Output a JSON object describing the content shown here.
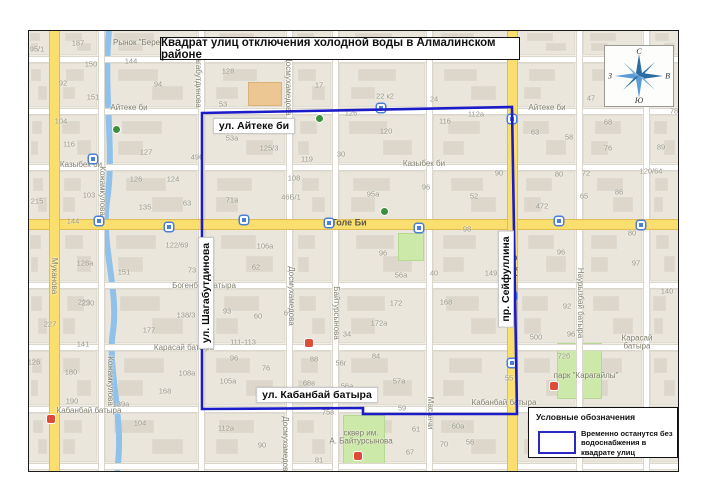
{
  "title": {
    "text": "Квадрат улиц  отключения холодной воды в Алмалинском районе"
  },
  "compass": {
    "north": "С",
    "east": "В",
    "south": "Ю",
    "west": "З"
  },
  "legend": {
    "heading": "Условные обозначения",
    "item": "Временно останутся без водоснабжения в квадрате улиц"
  },
  "colors": {
    "outline": "#1b1bc8",
    "swatch_border": "#2a2ac0",
    "major_road": "#fbdf6e",
    "major_road_edge": "#e0bc55",
    "road": "#ffffff",
    "road_edge": "#dbd7cd",
    "water": "#8fc1ea",
    "park": "#cde9a9",
    "park_edge": "#b7d893",
    "map_bg": "#f1eee6",
    "block": "#eae6dc",
    "block_edge": "#e2ddd2",
    "building": "#dcd7ca",
    "landmark": "#ecc793"
  },
  "map": {
    "width": 649,
    "height": 440,
    "h_streets": [
      {
        "y": 28,
        "major": false
      },
      {
        "y": 80,
        "major": false
      },
      {
        "y": 136,
        "major": false
      },
      {
        "y": 193,
        "major": true
      },
      {
        "y": 254,
        "major": false
      },
      {
        "y": 316,
        "major": false
      },
      {
        "y": 378,
        "major": false
      },
      {
        "y": 435,
        "major": false
      }
    ],
    "v_streets": [
      {
        "x": 25,
        "major": true
      },
      {
        "x": 72,
        "major": false
      },
      {
        "x": 172,
        "major": false
      },
      {
        "x": 260,
        "major": false
      },
      {
        "x": 306,
        "major": false
      },
      {
        "x": 400,
        "major": false
      },
      {
        "x": 483,
        "major": true
      },
      {
        "x": 550,
        "major": false
      },
      {
        "x": 617,
        "major": false
      }
    ],
    "street_labels": [
      {
        "t": "Айтеке би",
        "x": 100,
        "y": 77,
        "v": false
      },
      {
        "t": "Айтеке би",
        "x": 518,
        "y": 77,
        "v": false
      },
      {
        "t": "Казыбек би",
        "x": 52,
        "y": 134,
        "v": false
      },
      {
        "t": "Казыбек би",
        "x": 395,
        "y": 133,
        "v": false
      },
      {
        "t": "Богенбай батыра",
        "x": 175,
        "y": 255,
        "v": false
      },
      {
        "t": "Карасай батыра",
        "x": 155,
        "y": 317,
        "v": false
      },
      {
        "t": "Карасай батыра",
        "x": 608,
        "y": 312,
        "v": false
      },
      {
        "t": "Кабанбай батыра",
        "x": 60,
        "y": 380,
        "v": false
      },
      {
        "t": "Кабанбай батыра",
        "x": 475,
        "y": 372,
        "v": false
      },
      {
        "t": "Муканова",
        "x": 25,
        "y": 245,
        "v": true
      },
      {
        "t": "Кожамкулова",
        "x": 73,
        "y": 160,
        "v": true
      },
      {
        "t": "Кожамкулова",
        "x": 81,
        "y": 350,
        "v": true
      },
      {
        "t": "Шагабутдинова",
        "x": 169,
        "y": 48,
        "v": true
      },
      {
        "t": "Досмухамедова",
        "x": 259,
        "y": 55,
        "v": true
      },
      {
        "t": "Досмухамедова",
        "x": 262,
        "y": 265,
        "v": true
      },
      {
        "t": "Досмухамедова",
        "x": 256,
        "y": 415,
        "v": true
      },
      {
        "t": "Байтурсынова",
        "x": 307,
        "y": 282,
        "v": true
      },
      {
        "t": "Масанчи",
        "x": 401,
        "y": 382,
        "v": true
      },
      {
        "t": "Наурызбай батыра",
        "x": 551,
        "y": 272,
        "v": true
      }
    ],
    "road_labels": [
      {
        "t": "Толе Би",
        "x": 320,
        "y": 192,
        "v": false
      },
      {
        "t": "Сейфуллина",
        "x": 484,
        "y": 252,
        "v": true
      }
    ],
    "poi_labels": [
      {
        "t": "Рынок \"Береке\"",
        "x": 113,
        "y": 12
      },
      {
        "t": "сквер им.\nА. Байтурсынова",
        "x": 332,
        "y": 407
      },
      {
        "t": "парк \"Карагайлы\"",
        "x": 557,
        "y": 345
      }
    ],
    "annotations": [
      {
        "t": "ул. Айтеке би",
        "x": 225,
        "y": 95,
        "v": false
      },
      {
        "t": "ул. Кабанбай батыра",
        "x": 288,
        "y": 364,
        "v": false
      },
      {
        "t": "ул. Шагабутдинова",
        "x": 177,
        "y": 262,
        "v": true
      },
      {
        "t": "пр. Сейфуллина",
        "x": 477,
        "y": 248,
        "v": true
      }
    ],
    "house_numbers": [
      [
        "95/1",
        8,
        18
      ],
      [
        "187",
        49,
        12
      ],
      [
        "150",
        62,
        33
      ],
      [
        "92",
        34,
        52
      ],
      [
        "151",
        64,
        66
      ],
      [
        "144",
        102,
        30
      ],
      [
        "94",
        129,
        53
      ],
      [
        "128",
        199,
        40
      ],
      [
        "17",
        290,
        54
      ],
      [
        "22 к2",
        356,
        65
      ],
      [
        "24",
        405,
        68
      ],
      [
        "112а",
        447,
        83
      ],
      [
        "116",
        416,
        90
      ],
      [
        "120",
        357,
        100
      ],
      [
        "47",
        562,
        67
      ],
      [
        "78",
        645,
        80
      ],
      [
        "104",
        32,
        90
      ],
      [
        "116",
        40,
        113
      ],
      [
        "127",
        117,
        121
      ],
      [
        "496",
        168,
        126
      ],
      [
        "126",
        107,
        148
      ],
      [
        "124",
        144,
        148
      ],
      [
        "215",
        8,
        170
      ],
      [
        "103",
        60,
        164
      ],
      [
        "135",
        116,
        176
      ],
      [
        "63",
        158,
        172
      ],
      [
        "53",
        194,
        73
      ],
      [
        "53а",
        203,
        107
      ],
      [
        "125/3",
        240,
        117
      ],
      [
        "119",
        278,
        128
      ],
      [
        "126",
        322,
        82
      ],
      [
        "30",
        312,
        123
      ],
      [
        "108",
        265,
        147
      ],
      [
        "46Б/1",
        262,
        166
      ],
      [
        "95а",
        344,
        163
      ],
      [
        "96",
        397,
        156
      ],
      [
        "52",
        445,
        165
      ],
      [
        "90",
        470,
        142
      ],
      [
        "63",
        506,
        101
      ],
      [
        "58",
        540,
        106
      ],
      [
        "68",
        579,
        91
      ],
      [
        "76",
        579,
        117
      ],
      [
        "89",
        632,
        116
      ],
      [
        "80",
        530,
        143
      ],
      [
        "72",
        557,
        142
      ],
      [
        "65",
        555,
        165
      ],
      [
        "472",
        513,
        175
      ],
      [
        "86",
        590,
        161
      ],
      [
        "120/64",
        622,
        140
      ],
      [
        "71а",
        203,
        169
      ],
      [
        "144",
        44,
        190
      ],
      [
        "122/69",
        148,
        214
      ],
      [
        "128а",
        56,
        232
      ],
      [
        "151",
        95,
        241
      ],
      [
        "73",
        163,
        239
      ],
      [
        "106а",
        236,
        215
      ],
      [
        "62",
        227,
        236
      ],
      [
        "220",
        55,
        271
      ],
      [
        "138/3",
        157,
        284
      ],
      [
        "93",
        198,
        280
      ],
      [
        "60",
        229,
        285
      ],
      [
        "67",
        259,
        282
      ],
      [
        "96",
        354,
        222
      ],
      [
        "56а",
        372,
        244
      ],
      [
        "172",
        367,
        272
      ],
      [
        "172а",
        350,
        292
      ],
      [
        "40",
        405,
        242
      ],
      [
        "149",
        462,
        242
      ],
      [
        "168",
        417,
        271
      ],
      [
        "98",
        438,
        198
      ],
      [
        "80",
        603,
        202
      ],
      [
        "96",
        532,
        221
      ],
      [
        "97",
        607,
        232
      ],
      [
        "92",
        538,
        275
      ],
      [
        "96",
        542,
        303
      ],
      [
        "500",
        507,
        306
      ],
      [
        "140",
        638,
        260
      ],
      [
        "230",
        59,
        272
      ],
      [
        "227",
        21,
        293
      ],
      [
        "141",
        54,
        313
      ],
      [
        "177",
        120,
        299
      ],
      [
        "126",
        5,
        331
      ],
      [
        "180",
        42,
        341
      ],
      [
        "108а",
        158,
        342
      ],
      [
        "168",
        136,
        360
      ],
      [
        "190",
        43,
        370
      ],
      [
        "139а",
        92,
        373
      ],
      [
        "104",
        111,
        392
      ],
      [
        "111-113",
        214,
        311
      ],
      [
        "96",
        205,
        327
      ],
      [
        "76",
        237,
        337
      ],
      [
        "88",
        285,
        328
      ],
      [
        "68в",
        280,
        352
      ],
      [
        "105а",
        199,
        350
      ],
      [
        "56г",
        312,
        332
      ],
      [
        "56а",
        318,
        355
      ],
      [
        "84",
        347,
        325
      ],
      [
        "57а",
        370,
        350
      ],
      [
        "59",
        373,
        377
      ],
      [
        "34",
        318,
        303
      ],
      [
        "75в",
        299,
        381
      ],
      [
        "112а",
        197,
        397
      ],
      [
        "90",
        233,
        414
      ],
      [
        "81",
        290,
        429
      ],
      [
        "61",
        387,
        398
      ],
      [
        "67",
        381,
        421
      ],
      [
        "70",
        415,
        413
      ],
      [
        "72б",
        535,
        325
      ],
      [
        "55",
        480,
        347
      ],
      [
        "60а",
        429,
        395
      ],
      [
        "56",
        441,
        411
      ]
    ],
    "icons": [
      {
        "k": "bus",
        "x": 70,
        "y": 190
      },
      {
        "k": "bus",
        "x": 140,
        "y": 196
      },
      {
        "k": "bus",
        "x": 215,
        "y": 189
      },
      {
        "k": "bus",
        "x": 300,
        "y": 192
      },
      {
        "k": "bus",
        "x": 390,
        "y": 197
      },
      {
        "k": "bus",
        "x": 530,
        "y": 190
      },
      {
        "k": "bus",
        "x": 612,
        "y": 194
      },
      {
        "k": "bus",
        "x": 483,
        "y": 88
      },
      {
        "k": "bus",
        "x": 483,
        "y": 265
      },
      {
        "k": "bus",
        "x": 483,
        "y": 332
      },
      {
        "k": "bus",
        "x": 64,
        "y": 128
      },
      {
        "k": "bus",
        "x": 352,
        "y": 77
      },
      {
        "k": "red",
        "x": 22,
        "y": 388
      },
      {
        "k": "red",
        "x": 329,
        "y": 425
      },
      {
        "k": "red",
        "x": 525,
        "y": 355
      },
      {
        "k": "red",
        "x": 280,
        "y": 312
      },
      {
        "k": "green",
        "x": 87,
        "y": 98
      },
      {
        "k": "green",
        "x": 290,
        "y": 87
      },
      {
        "k": "green",
        "x": 355,
        "y": 180
      }
    ],
    "parks": [
      [
        370,
        203,
        24,
        26
      ],
      [
        315,
        385,
        40,
        47
      ],
      [
        529,
        313,
        43,
        54
      ]
    ],
    "landmarks": [
      [
        220,
        52,
        32,
        22
      ]
    ],
    "water_path": "M 80,0 C 74,60 86,120 78,170 C 72,215 90,260 84,300 C 78,340 96,390 88,440",
    "outline_points": "173,82 483,76 488,383 334,383 334,377 173,378"
  }
}
